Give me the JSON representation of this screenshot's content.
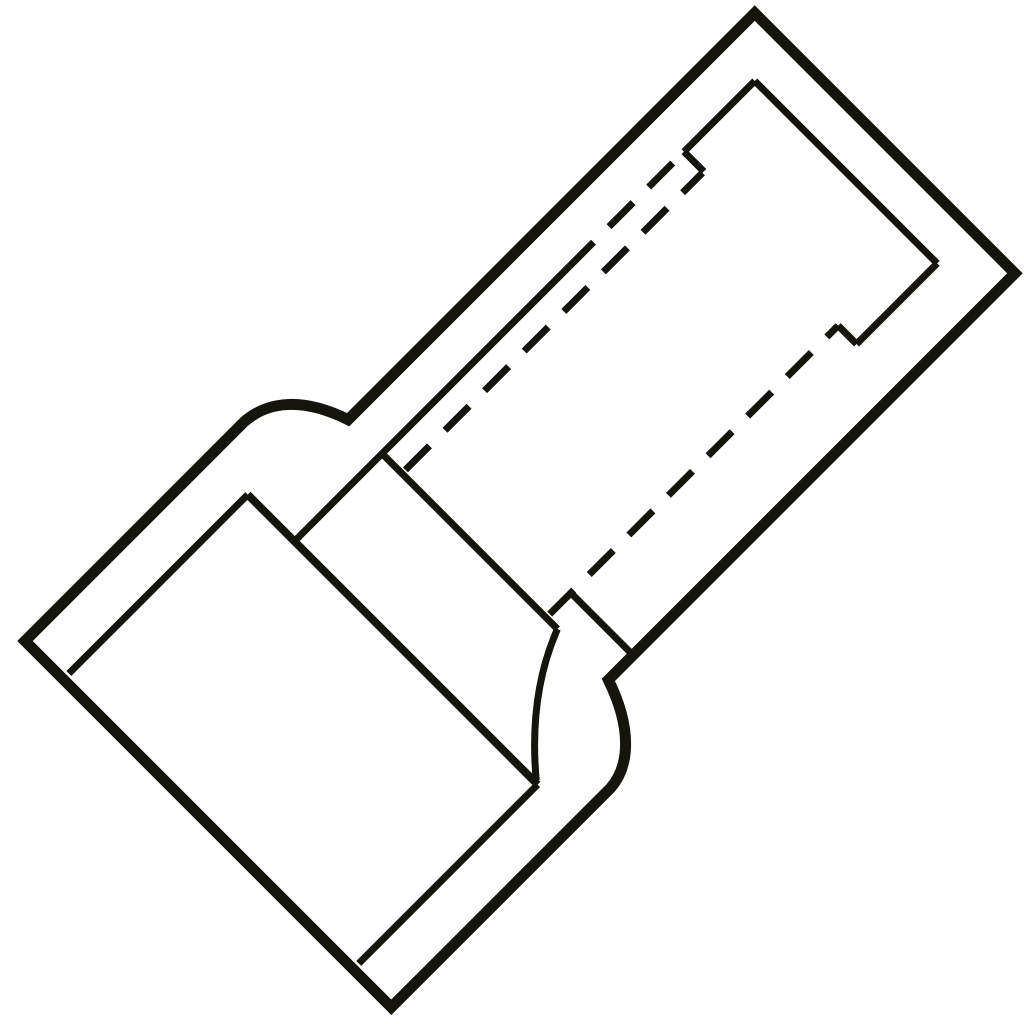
{
  "figure": {
    "description": "Technical line drawing of an insulated crimp splice connector (reducer butt connector), shown diagonally",
    "canvas": {
      "width": 1024,
      "height": 1024,
      "background": "#ffffff"
    },
    "colors": {
      "fill": "#f6f6d4",
      "stroke": "#15150e"
    },
    "transform": {
      "translate_x": 25,
      "translate_y": 641,
      "rotate_deg": -45
    },
    "dash_pattern": "34 22",
    "stroke_widths": {
      "outer": 11,
      "flange": 8,
      "inner": 7
    },
    "paths": [
      {
        "name": "connector-outline",
        "d": "M 0 0 L 310 0 C 340 2 368 22 385 72 L 960 72 L 960 440 L 385 440 C 368 490 340 516 310 518 L 0 518 Z",
        "width": "outer",
        "dashed": false,
        "filled": true
      },
      {
        "name": "funnel-flange-edge",
        "d": "M 261 54 L 261 464",
        "width": "flange",
        "dashed": false,
        "filled": false
      },
      {
        "name": "funnel-bore-top-edge",
        "d": "M 8 54 L 261 54",
        "width": "inner",
        "dashed": false,
        "filled": false
      },
      {
        "name": "funnel-bore-bottom-edge",
        "d": "M 8 464 L 261 464",
        "width": "inner",
        "dashed": false,
        "filled": false
      },
      {
        "name": "barrel-top-side-solid",
        "d": "M 261 120 L 650 120",
        "width": "inner",
        "dashed": false,
        "filled": false
      },
      {
        "name": "barrel-top-side-hidden",
        "d": "M 650 120 L 798 120",
        "width": "inner",
        "dashed": true,
        "filled": false
      },
      {
        "name": "barrel-end-top-side",
        "d": "M 812 120 L 912 120",
        "width": "inner",
        "dashed": false,
        "filled": false
      },
      {
        "name": "barrel-top-step-tick",
        "d": "M 812 120 L 812 148",
        "width": "inner",
        "dashed": false,
        "filled": false
      },
      {
        "name": "bore-hidden-line-upper",
        "d": "M 390 148 L 810 148",
        "width": "inner",
        "dashed": true,
        "filled": false
      },
      {
        "name": "barrel-left-end-edge",
        "d": "M 385 120 L 385 368",
        "width": "inner",
        "dashed": false,
        "filled": false
      },
      {
        "name": "shoulder-inner-arc",
        "d": "M 385 368 Q 318 394 263 460",
        "width": "inner",
        "dashed": false,
        "filled": false
      },
      {
        "name": "barrel-right-end-edge",
        "d": "M 912 120 L 912 378",
        "width": "inner",
        "dashed": false,
        "filled": false
      },
      {
        "name": "barrel-end-bottom-side",
        "d": "M 798 378 L 912 378",
        "width": "inner",
        "dashed": false,
        "filled": false
      },
      {
        "name": "barrel-bottom-step-tick",
        "d": "M 798 352 L 798 378",
        "width": "inner",
        "dashed": false,
        "filled": false
      },
      {
        "name": "bore-hidden-line-lower",
        "d": "M 390 352 L 798 352",
        "width": "inner",
        "dashed": true,
        "filled": false
      },
      {
        "name": "sleeve-inner-cross-edge",
        "d": "M 420 352 L 420 442",
        "width": "inner",
        "dashed": false,
        "filled": false
      }
    ]
  }
}
